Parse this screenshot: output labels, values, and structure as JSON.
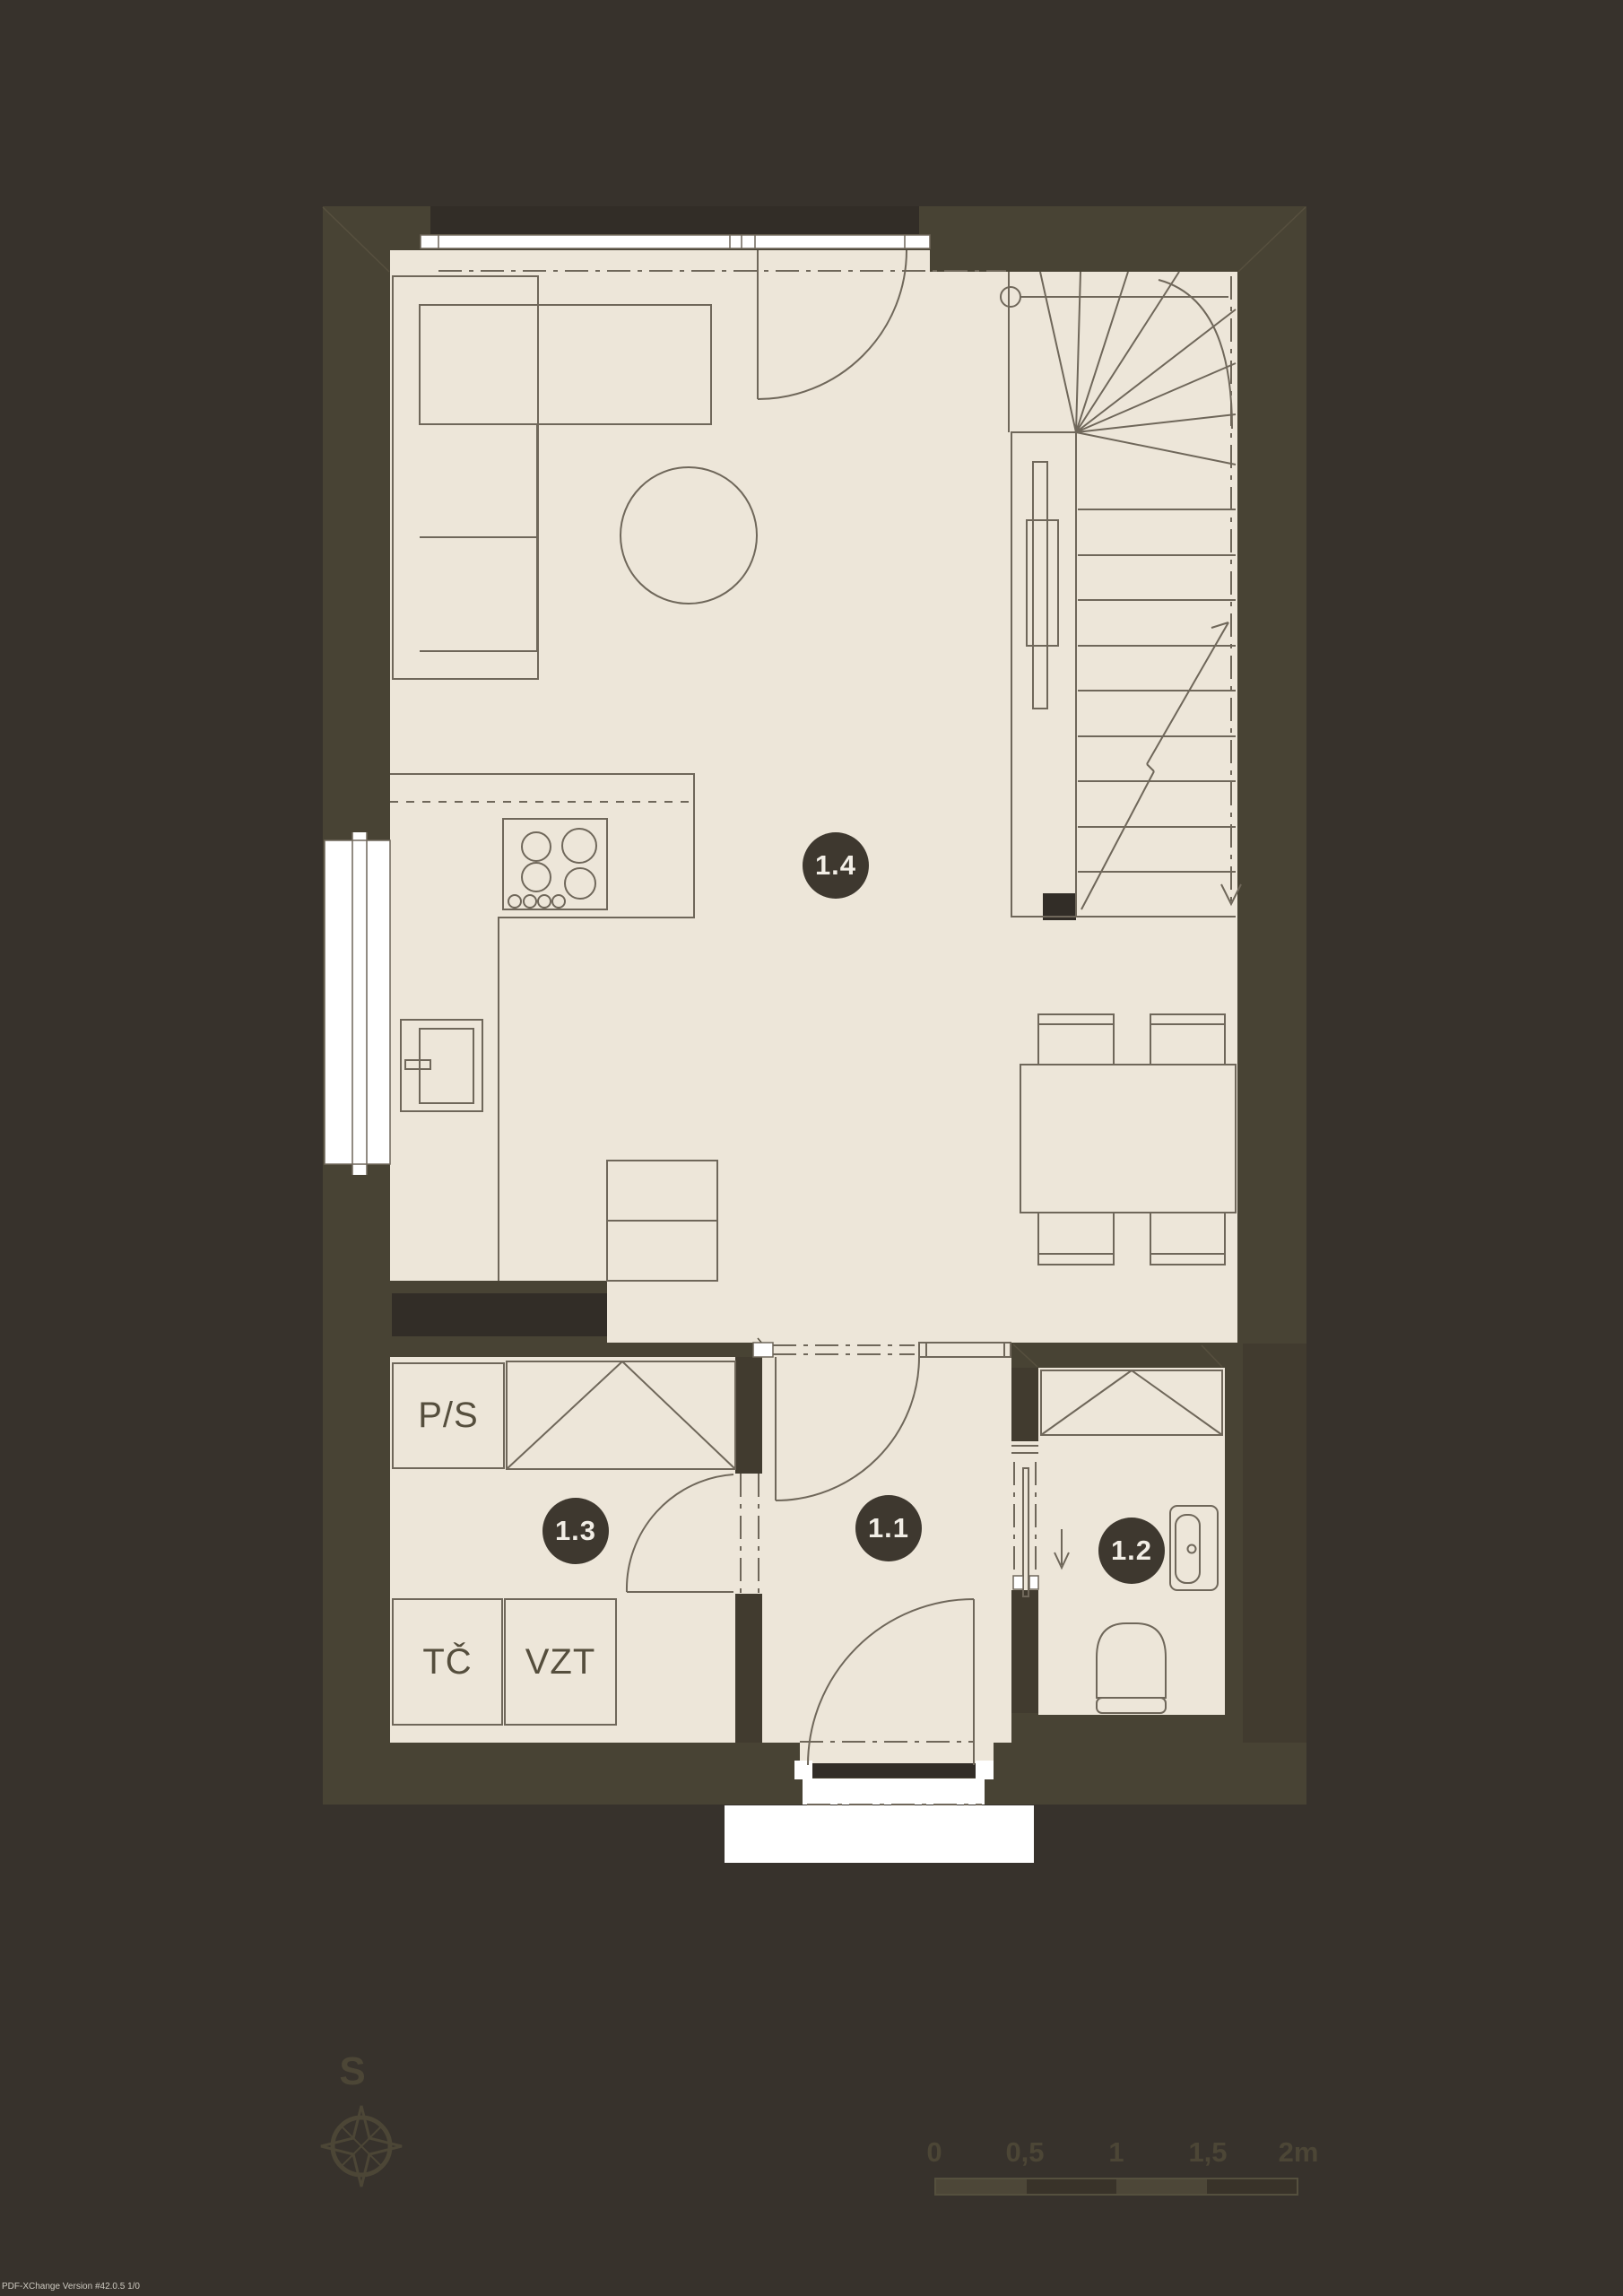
{
  "rooms": {
    "r11": "1.1",
    "r12": "1.2",
    "r13": "1.3",
    "r14": "1.4"
  },
  "tech": {
    "ps": "P/S",
    "tc": "TČ",
    "vzt": "VZT"
  },
  "compass": {
    "north_label": "S"
  },
  "scale_bar": {
    "ticks": [
      "0",
      "0,5",
      "1",
      "1,5",
      "2m"
    ]
  },
  "watermark": "PDF-XChange Version #42.0.5 1/0",
  "colors": {
    "background": "#37322c",
    "wall": "#484334",
    "wall_dark_fill": "#413b2f",
    "wall_black_fill": "#322d27",
    "floor": "#ede6d9",
    "drawing_line": "#6f675a",
    "label_circle": "#3e382f",
    "label_text": "#f2eee6",
    "annotation": "#4c4636",
    "window": "#ffffff"
  }
}
